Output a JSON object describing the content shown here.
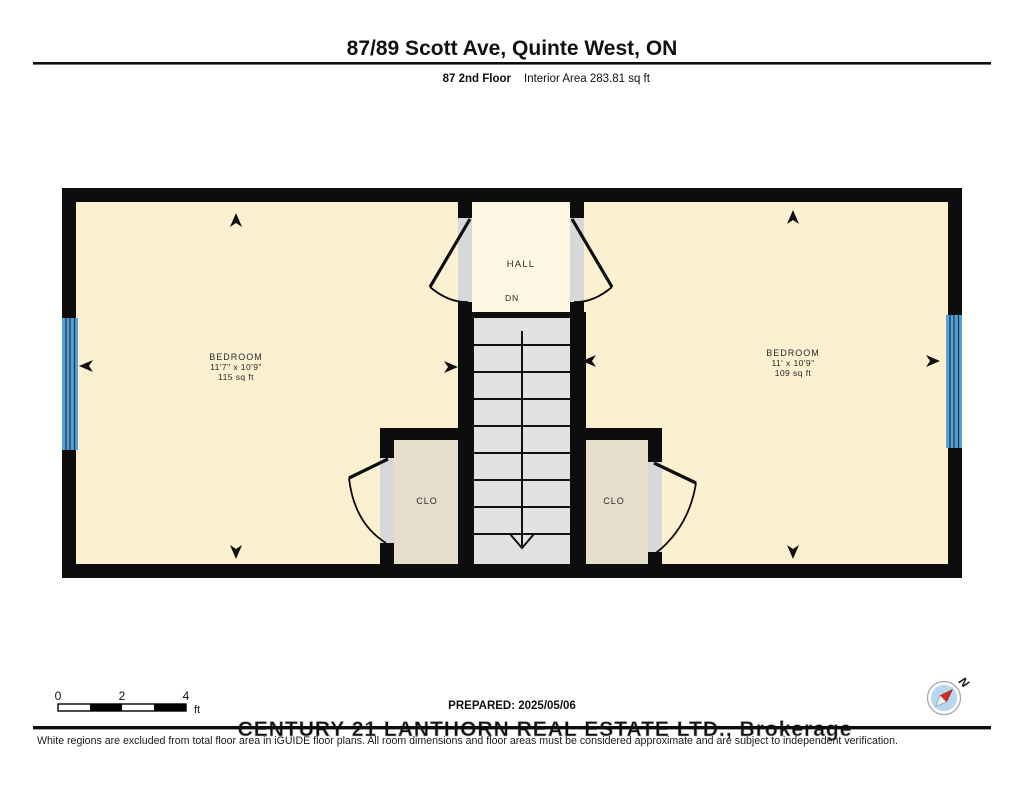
{
  "header": {
    "title": "87/89 Scott Ave, Quinte West, ON",
    "floor_label": "87 2nd Floor",
    "area_label": "Interior Area 283.81 sq ft"
  },
  "rooms": {
    "bedroom_left": {
      "name": "BEDROOM",
      "dims": "11'7\" x 10'9\"",
      "area": "115 sq ft"
    },
    "bedroom_right": {
      "name": "BEDROOM",
      "dims": "11' x 10'9\"",
      "area": "109 sq ft"
    },
    "hall": {
      "name": "HALL",
      "stairs_label": "DN"
    },
    "closet_left": {
      "name": "CLO"
    },
    "closet_right": {
      "name": "CLO"
    }
  },
  "scale_bar": {
    "tick0": "0",
    "tick1": "2",
    "tick2": "4",
    "unit": "ft"
  },
  "footer": {
    "prepared": "PREPARED: 2025/05/06",
    "watermark": "CENTURY 21 LANTHORN REAL ESTATE LTD., Brokerage",
    "disclaimer": "White regions are excluded from total floor area in iGUIDE floor plans. All room dimensions and floor areas must be considered approximate and are subject to independent verification."
  },
  "compass": {
    "label": "N"
  },
  "colors": {
    "wall": "#0d0d0d",
    "room_fill": "#fbf0d0",
    "hall_fill": "#fdf6e2",
    "closet_fill": "#e5decd",
    "stair_fill": "#e2e2e2",
    "door_fill": "#d8d8d8",
    "window": "#55a1d6",
    "marker": "#101010",
    "compass_face": "#b5d7f0",
    "needle_red": "#d42b1e"
  }
}
